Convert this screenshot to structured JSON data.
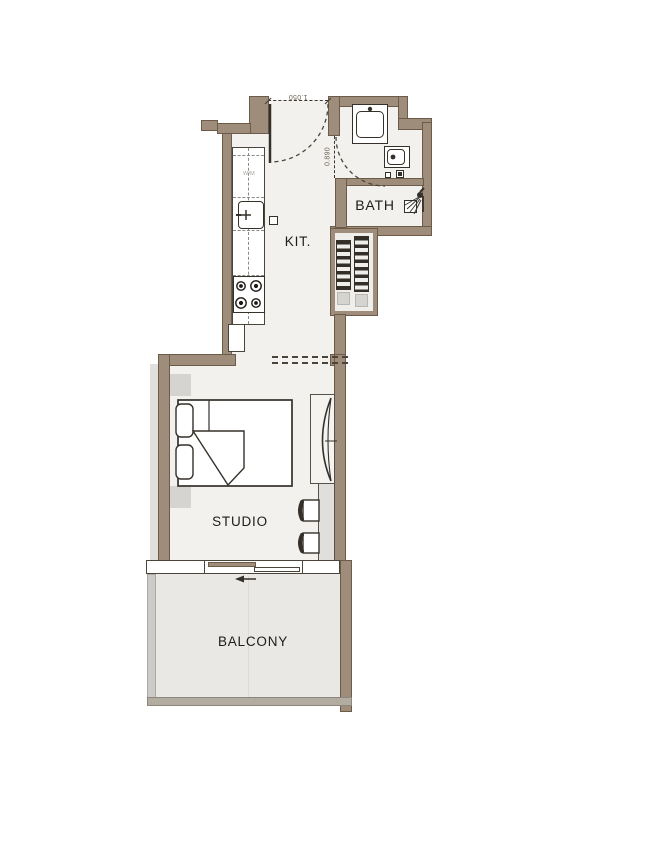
{
  "floorplan": {
    "type": "residential-studio-unit-plan",
    "rooms": {
      "kitchen": {
        "label": "KIT."
      },
      "bath": {
        "label": "BATH"
      },
      "studio": {
        "label": "STUDIO"
      },
      "balcony": {
        "label": "BALCONY"
      }
    },
    "appliances": {
      "washer_label": "W/M"
    },
    "dimensions": {
      "entry_door_width_m": "1.050",
      "bath_door_width_m": "0.890"
    },
    "icons": [
      {
        "name": "entry-door-swing-icon",
        "meaning": "entrance door swing arc"
      },
      {
        "name": "bath-door-swing-icon",
        "meaning": "bath door swing arc"
      },
      {
        "name": "kitchen-sink-icon",
        "meaning": "kitchen sink with faucet"
      },
      {
        "name": "stove-burners-icon",
        "meaning": "4-burner cooktop"
      },
      {
        "name": "washbasin-icon",
        "meaning": "bath washbasin"
      },
      {
        "name": "toilet-icon",
        "meaning": "toilet"
      },
      {
        "name": "shower-icon",
        "meaning": "wall shower head"
      },
      {
        "name": "double-bed-icon",
        "meaning": "bed with pillows and folded blanket"
      },
      {
        "name": "wardrobe-icon",
        "meaning": "wardrobe with curved front"
      },
      {
        "name": "table-chairs-icon",
        "meaning": "counter table with two chairs"
      },
      {
        "name": "sliding-door-icon",
        "meaning": "sliding balcony door with direction arrow"
      },
      {
        "name": "ac-shaft-hatch",
        "meaning": "hatched services / A-C shaft"
      }
    ],
    "colors": {
      "wall": "#9e8d7b",
      "wall_outline": "#6b5b48",
      "floor": "#f2f1ee",
      "balcony_floor": "#e9e8e5",
      "fixture_outline": "#35302a",
      "fixture_gray": "#d5d4d0",
      "hatch_dark": "#332e27",
      "background": "#ffffff",
      "label_text": "#1d1c1a",
      "dimension_text": "#6e6052"
    }
  }
}
